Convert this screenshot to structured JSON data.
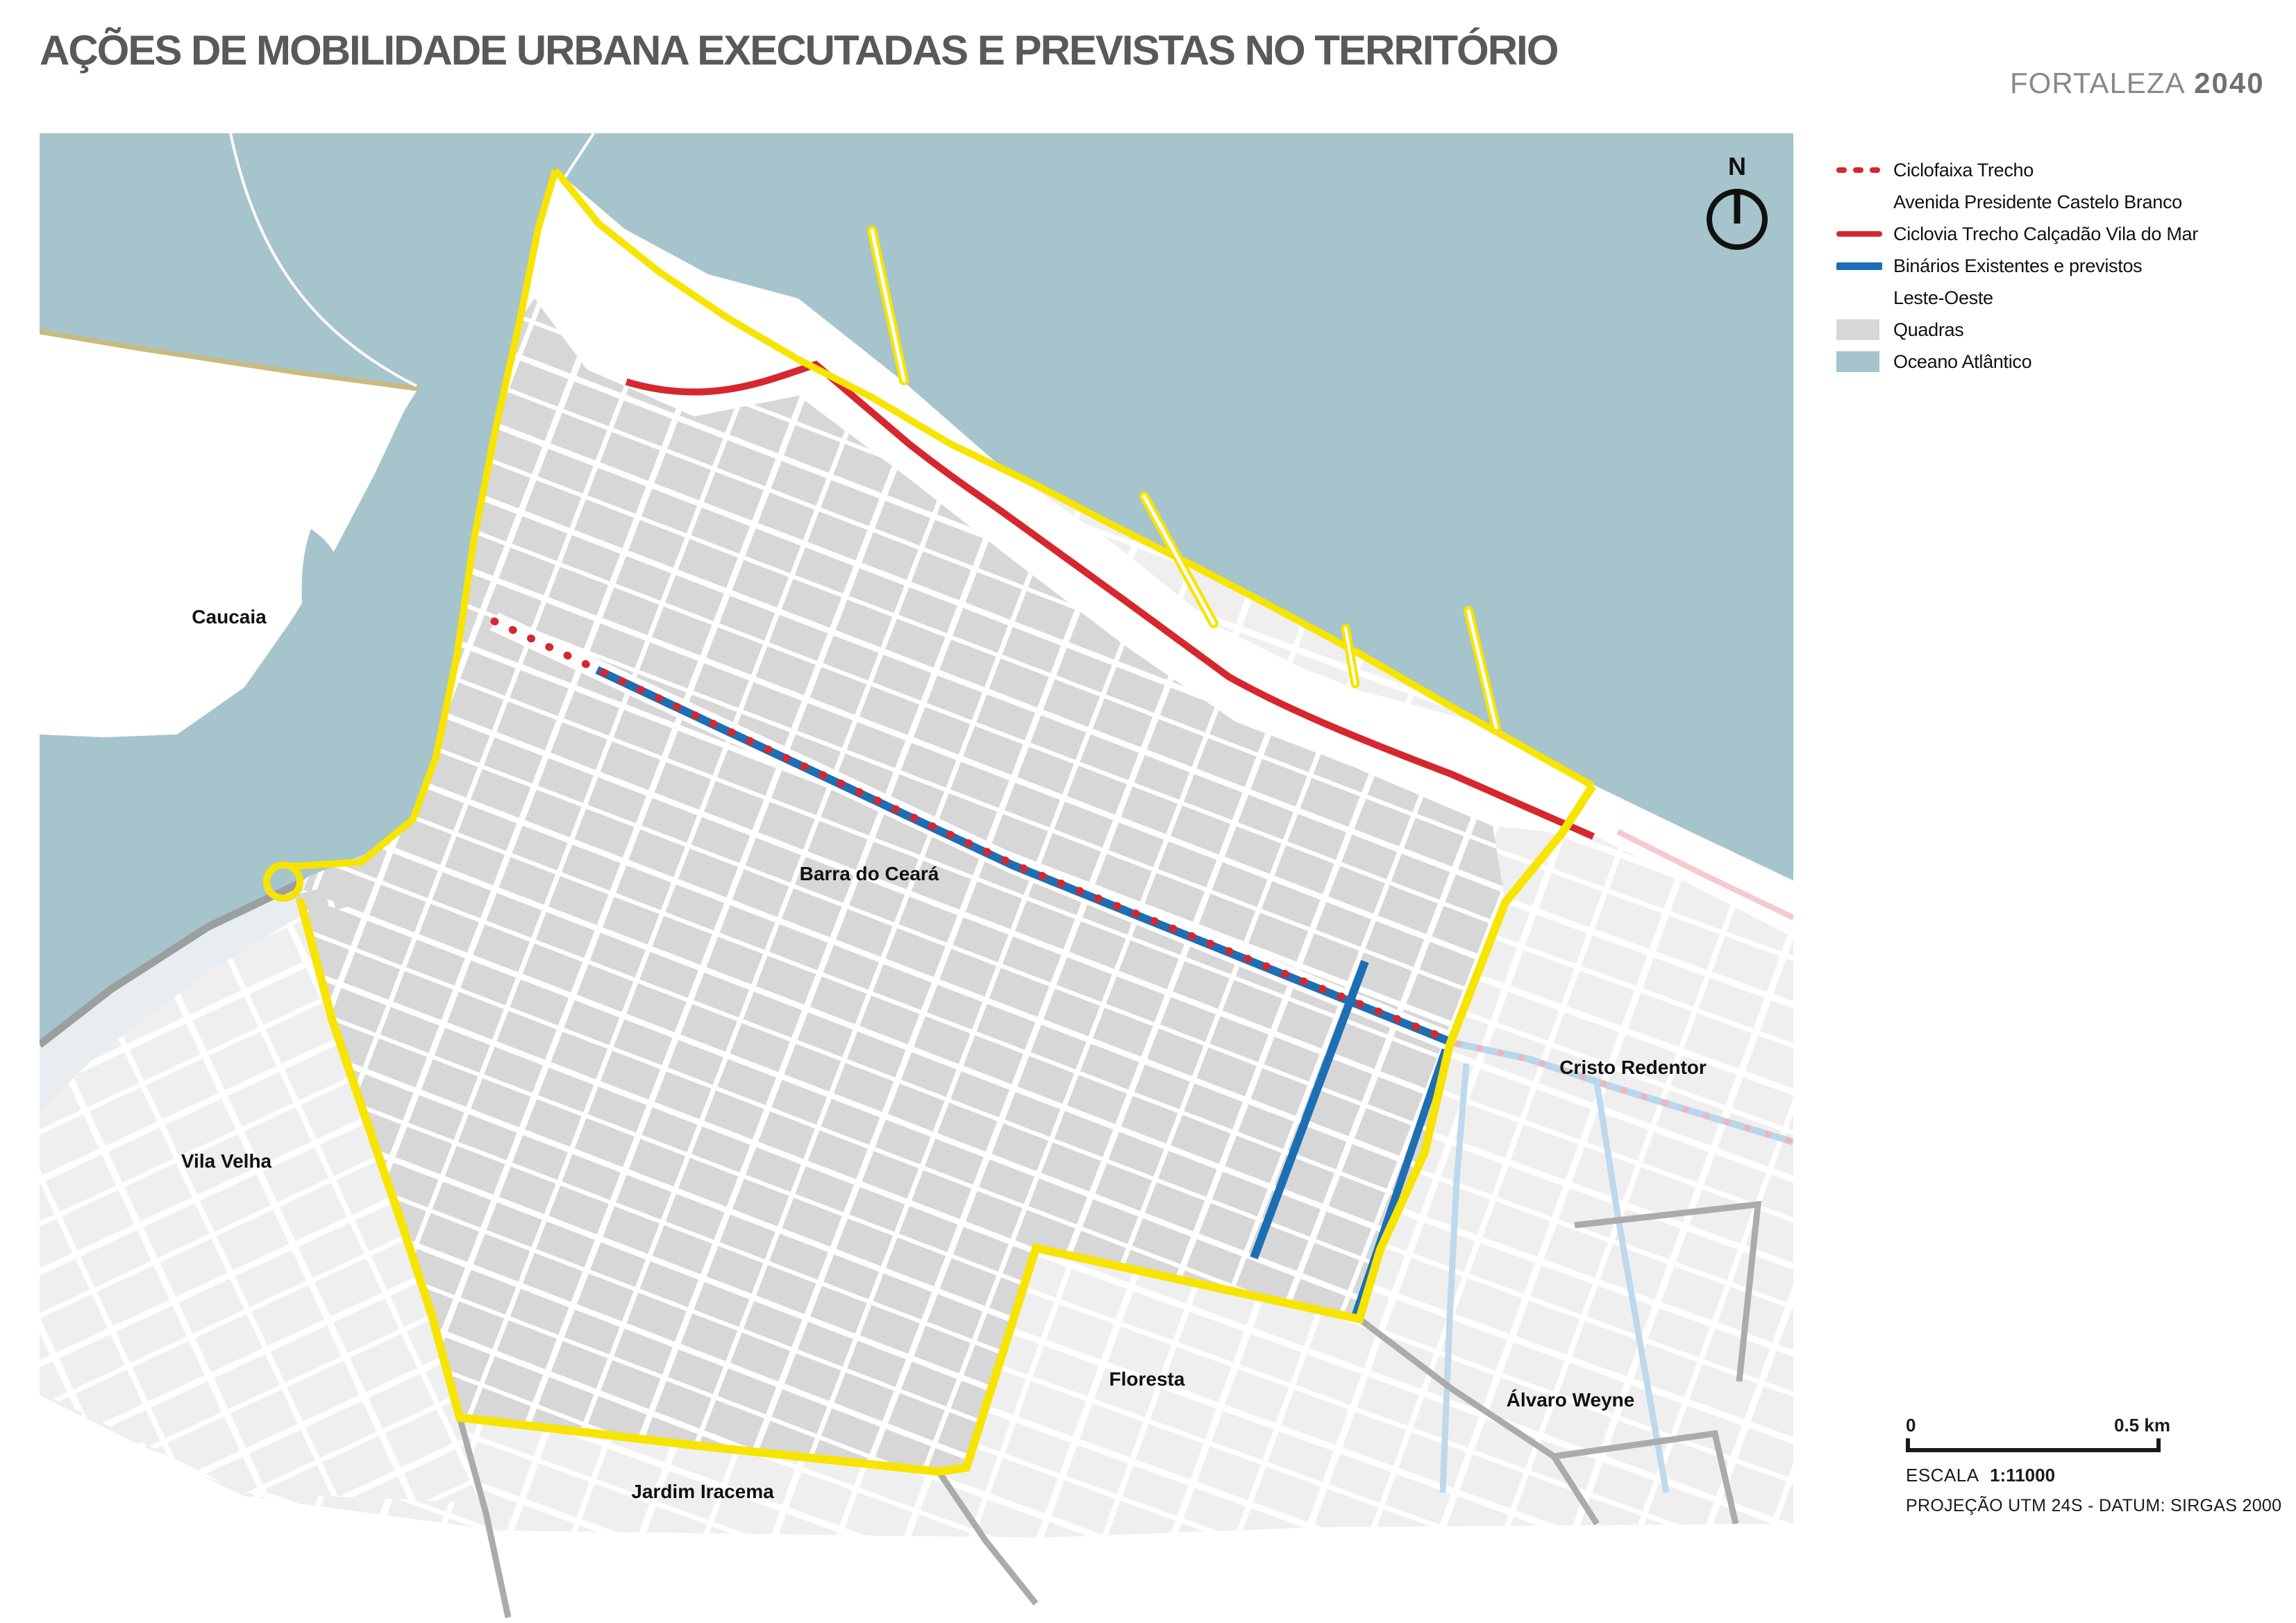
{
  "title": "AÇÕES DE MOBILIDADE URBANA EXECUTADAS E PREVISTAS NO TERRITÓRIO",
  "logo": {
    "brand": "FORTALEZA",
    "year": "2040"
  },
  "compass": {
    "label": "N"
  },
  "legend": {
    "items": [
      {
        "id": "ciclofaixa",
        "swatch": "dashed-red",
        "label_lines": [
          "Ciclofaixa Trecho",
          "Avenida Presidente Castelo Branco"
        ]
      },
      {
        "id": "ciclovia",
        "swatch": "solid-red",
        "label_lines": [
          "Ciclovia Trecho Calçadão Vila do Mar"
        ]
      },
      {
        "id": "binarios",
        "swatch": "solid-blue",
        "label_lines": [
          "Binários Existentes e previstos",
          "Leste-Oeste"
        ]
      },
      {
        "id": "quadras",
        "swatch": "fill-gray",
        "label_lines": [
          "Quadras"
        ]
      },
      {
        "id": "oceano",
        "swatch": "fill-ocean",
        "label_lines": [
          "Oceano Atlântico"
        ]
      }
    ]
  },
  "map_labels": {
    "caucaia": "Caucaia",
    "vila_velha": "Vila Velha",
    "barra_do_ceara": "Barra do Ceará",
    "cristo_redentor": "Cristo Redentor",
    "floresta": "Floresta",
    "alvaro_weyne": "Álvaro Weyne",
    "jardim_iracema": "Jardim Iracema"
  },
  "scale": {
    "start": "0",
    "end": "0.5 km",
    "escala_label": "ESCALA",
    "escala_value": "1:11000",
    "projection": "PROJEÇÃO UTM 24S - DATUM: SIRGAS 2000"
  },
  "colors": {
    "ocean": "#a6c4cb",
    "quadras": "#d7d7d7",
    "outside_blocks": "#efefef",
    "territory_boundary_yellow": "#f7e400",
    "ciclofaixa_red": "#d6272e",
    "ciclovia_red": "#d6272e",
    "binarios_blue": "#1e6eb4",
    "faded_route_pink": "#f2b3bb",
    "faded_route_blue": "#b9d7ea",
    "canal_blue": "#bcd9ed",
    "district_boundary_gray": "#ababab",
    "shoreline_tan": "#c9ba7e",
    "title_gray": "#58595b"
  }
}
